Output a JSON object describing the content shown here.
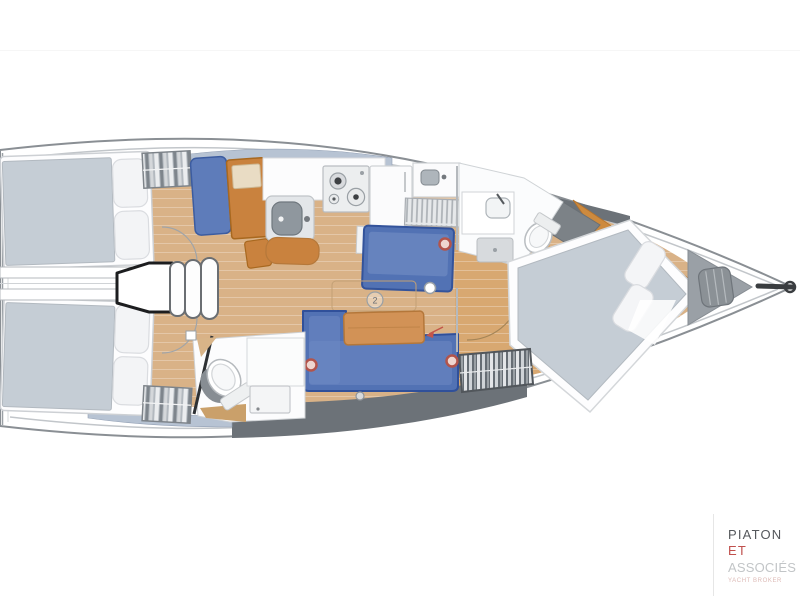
{
  "title": "Sailboat interior deck plan",
  "logo": {
    "line1": "PIATON",
    "line2": "ET",
    "line3": "ASSOCIÉS",
    "tagline": "YACHT BROKER"
  },
  "markers": {
    "circle2": "2"
  },
  "colors": {
    "hull_outline": "#8a8f94",
    "floor_wood": "#d9b287",
    "furniture_wood": "#c9823e",
    "table_wood": "#d29256",
    "sofa_blue": "#5272b4",
    "seat_blue": "#5e7cba",
    "mattress_gray": "#c5cdd5",
    "deck_band_gray": "#6c7278",
    "window_strip_blue": "#b7c3d3",
    "marker_red": "#b2544b",
    "bow_locker_gray": "#9aa0a6",
    "logo_primary": "#55585c",
    "logo_accent": "#c0504d",
    "logo_light": "#c2c5c7"
  }
}
